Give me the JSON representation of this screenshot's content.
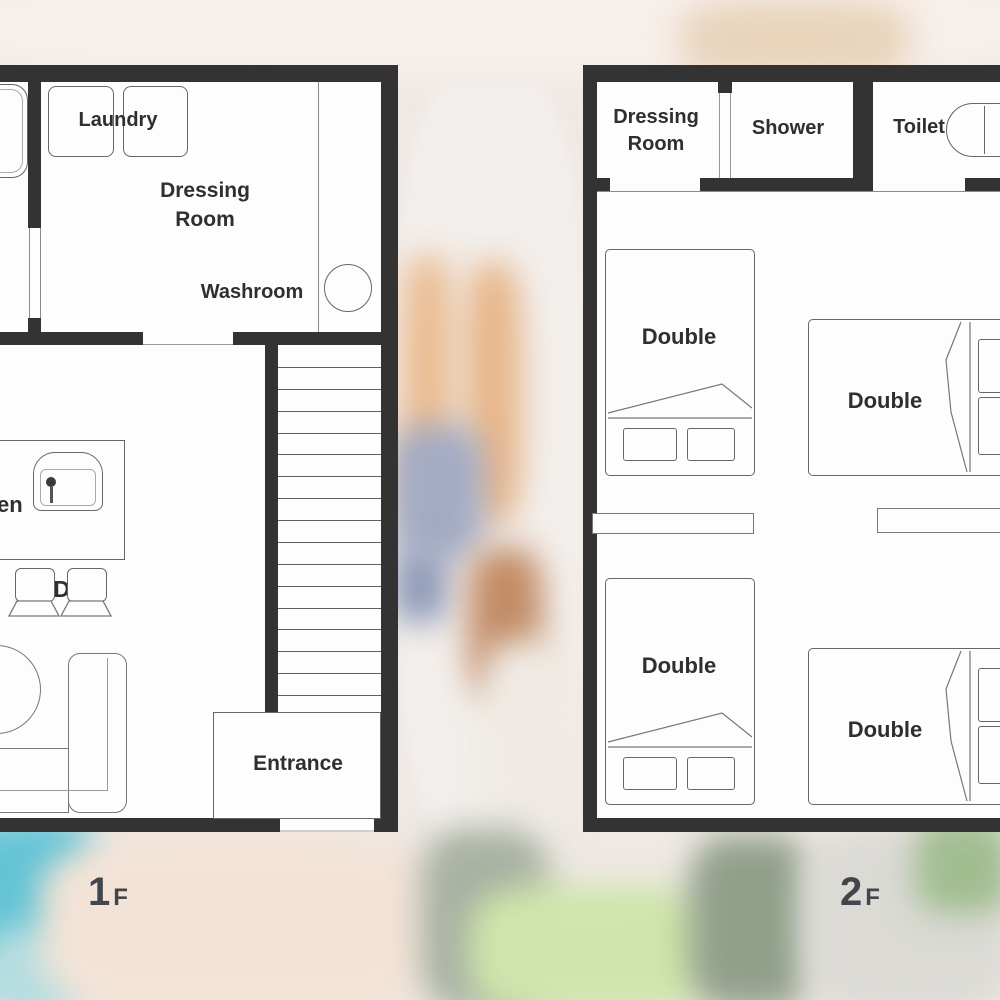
{
  "page": {
    "title": "House floor plans 1F and 2F"
  },
  "colors": {
    "wall": "#333333",
    "line2": "#8a8a8a",
    "text": "#2f2f2f",
    "teal_accent": "#64c4d6",
    "tan_accent": "#eaba8e",
    "green_accent": "#cfe5ab"
  },
  "floor1": {
    "label_big": "1",
    "label_small": "F",
    "stairs_steps": 17,
    "rooms": {
      "laundry": "Laundry",
      "dressing_line1": "Dressing",
      "dressing_line2": "Room",
      "washroom": "Washroom",
      "kitchen": "Kitchen",
      "ldk": "LDK",
      "entrance": "Entrance"
    }
  },
  "floor2": {
    "label_big": "2",
    "label_small": "F",
    "rooms": {
      "dressing_line1": "Dressing",
      "dressing_line2": "Room",
      "shower": "Shower",
      "toilet": "Toilet"
    },
    "beds": [
      {
        "label": "Double"
      },
      {
        "label": "Double"
      },
      {
        "label": "Double"
      },
      {
        "label": "Double"
      }
    ]
  }
}
